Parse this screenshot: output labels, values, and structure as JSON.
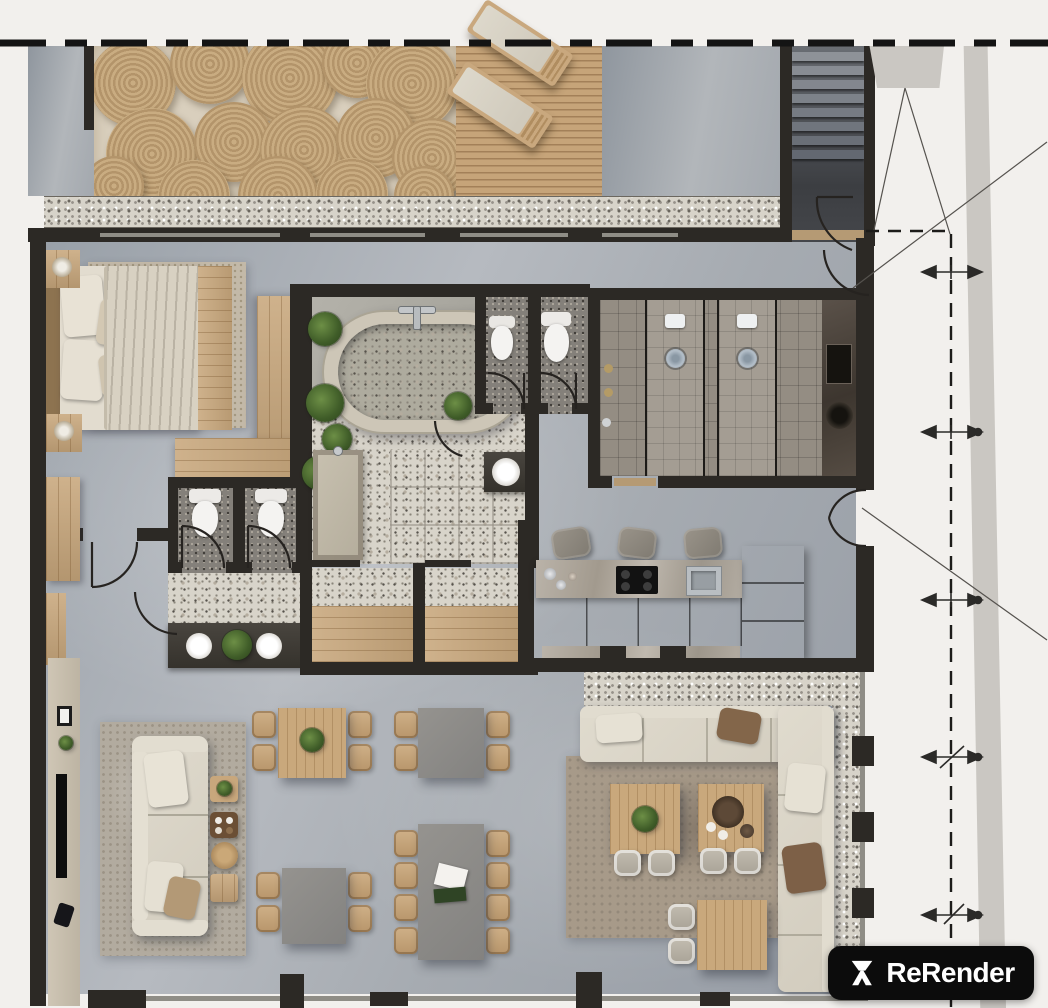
{
  "watermark": {
    "label": "ReRender"
  },
  "palette": {
    "bg": "#f2f0ed",
    "wall": "#2c2925",
    "wall_soft": "#55524c",
    "wood": "#c8a77c",
    "wood_dark": "#a98a5f",
    "linen": "#e2dccf",
    "sofa_cream": "#d9d4c6",
    "table_gray": "#8c8b89",
    "rug_gray": "#b2ab9f",
    "rug_brown": "#a79a89",
    "annot": "#4a4845",
    "glass": "#8f8d86",
    "strip_gray": "#cac7c2",
    "wm_bg": "#0c0c0c",
    "wm_fg": "#ffffff"
  },
  "scene": {
    "rooms": [
      "terrace",
      "stairwell",
      "bedroom",
      "bathroom",
      "wc-stalls",
      "shower-room",
      "dressing-bays",
      "kitchen",
      "living-room",
      "dining-area",
      "lounge"
    ],
    "furniture": [
      "round-mat-rug",
      "sun-loungers",
      "double-bed",
      "nightstands",
      "wardrobe",
      "freestanding-bathtub",
      "toilets",
      "washbasins",
      "walk-in-showers",
      "vanity",
      "kitchen-island",
      "bar-stools",
      "induction-hob",
      "kitchen-sink",
      "tall-cabinets",
      "tv-console",
      "three-seat-sofa",
      "side-tables",
      "dining-tables",
      "dining-chairs",
      "sectional-sofa",
      "coffee-tables"
    ],
    "annotations": {
      "boundary_style": "dashed-line",
      "dimension_arrows": 5,
      "reference_lines": 4
    }
  }
}
